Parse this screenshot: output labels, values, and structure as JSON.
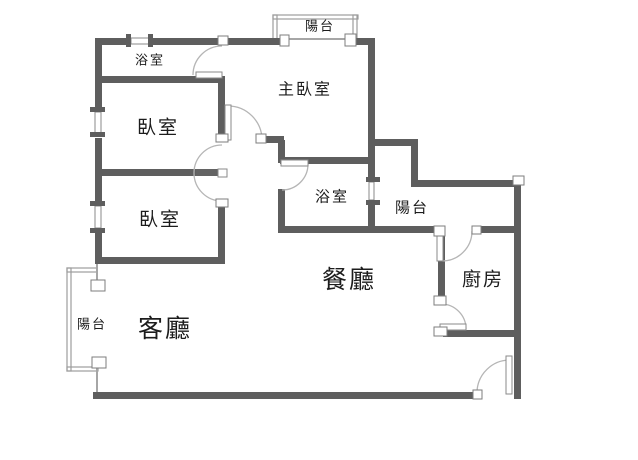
{
  "plan": {
    "title": "apartment-floor-plan",
    "canvas": {
      "w": 638,
      "h": 460
    },
    "colors": {
      "background": "#ffffff",
      "wall": "#5e5e5e",
      "thin_line": "#a6a6a6",
      "railing": "#9d9d9d",
      "arc": "#b5b5b5",
      "post_fill": "#ffffff",
      "post_border": "#7d7d7d",
      "window_fill": "#ffffff",
      "window_border": "#8a8a8a",
      "leaf_light_fill": "#ffffff",
      "leaf_light_border": "#8a8a8a",
      "leaf_dark": "#636363",
      "text": "#1c1c1c"
    },
    "rooms": [
      {
        "id": "balcony-top",
        "label": "陽台",
        "x": 320,
        "y": 27,
        "size": 13
      },
      {
        "id": "bathroom-master",
        "label": "浴室",
        "x": 150,
        "y": 61,
        "size": 13
      },
      {
        "id": "master-bedroom",
        "label": "主臥室",
        "x": 305,
        "y": 90,
        "size": 16
      },
      {
        "id": "bedroom-1",
        "label": "臥室",
        "x": 158,
        "y": 128,
        "size": 19
      },
      {
        "id": "bedroom-2",
        "label": "臥室",
        "x": 160,
        "y": 220,
        "size": 19
      },
      {
        "id": "bathroom-2",
        "label": "浴室",
        "x": 332,
        "y": 197,
        "size": 15
      },
      {
        "id": "balcony-right",
        "label": "陽台",
        "x": 412,
        "y": 208,
        "size": 15
      },
      {
        "id": "dining-room",
        "label": "餐廳",
        "x": 349,
        "y": 281,
        "size": 25
      },
      {
        "id": "kitchen",
        "label": "廚房",
        "x": 483,
        "y": 280,
        "size": 19
      },
      {
        "id": "living-room",
        "label": "客廳",
        "x": 165,
        "y": 330,
        "size": 25
      },
      {
        "id": "balcony-left",
        "label": "陽台",
        "x": 92,
        "y": 325,
        "size": 13
      }
    ],
    "walls": [
      {
        "x": 95,
        "y": 38,
        "w": 33,
        "h": 7
      },
      {
        "x": 153,
        "y": 38,
        "w": 67,
        "h": 7
      },
      {
        "x": 228,
        "y": 38,
        "w": 54,
        "h": 7
      },
      {
        "x": 354,
        "y": 38,
        "w": 21,
        "h": 7
      },
      {
        "x": 95,
        "y": 38,
        "w": 7,
        "h": 69
      },
      {
        "x": 95,
        "y": 138,
        "w": 7,
        "h": 63
      },
      {
        "x": 95,
        "y": 233,
        "w": 7,
        "h": 31
      },
      {
        "x": 98,
        "y": 76,
        "w": 126,
        "h": 7
      },
      {
        "x": 218,
        "y": 76,
        "w": 7,
        "h": 60
      },
      {
        "x": 218,
        "y": 206,
        "w": 7,
        "h": 58
      },
      {
        "x": 98,
        "y": 169,
        "w": 100,
        "h": 7
      },
      {
        "x": 95,
        "y": 257,
        "w": 130,
        "h": 7
      },
      {
        "x": 368,
        "y": 38,
        "w": 7,
        "h": 140
      },
      {
        "x": 368,
        "y": 204,
        "w": 7,
        "h": 29
      },
      {
        "x": 261,
        "y": 136,
        "w": 23,
        "h": 7
      },
      {
        "x": 278,
        "y": 140,
        "w": 7,
        "h": 23
      },
      {
        "x": 280,
        "y": 157,
        "w": 95,
        "h": 7
      },
      {
        "x": 278,
        "y": 189,
        "w": 7,
        "h": 44
      },
      {
        "x": 278,
        "y": 226,
        "w": 160,
        "h": 7
      },
      {
        "x": 479,
        "y": 226,
        "w": 40,
        "h": 7
      },
      {
        "x": 370,
        "y": 139,
        "w": 48,
        "h": 7
      },
      {
        "x": 411,
        "y": 141,
        "w": 7,
        "h": 46
      },
      {
        "x": 411,
        "y": 180,
        "w": 110,
        "h": 7
      },
      {
        "x": 514,
        "y": 183,
        "w": 7,
        "h": 216
      },
      {
        "x": 438,
        "y": 233,
        "w": 7,
        "h": 65
      },
      {
        "x": 443,
        "y": 330,
        "w": 76,
        "h": 7
      },
      {
        "x": 93,
        "y": 392,
        "w": 384,
        "h": 7
      }
    ],
    "thin_lines": [
      {
        "x": 289,
        "y": 38,
        "w": 57,
        "h": 2
      },
      {
        "x": 96,
        "y": 263,
        "w": 2,
        "h": 18
      },
      {
        "x": 96,
        "y": 367,
        "w": 2,
        "h": 26
      }
    ],
    "railings": [
      {
        "x": 273,
        "y": 15,
        "w": 85,
        "h": 4
      },
      {
        "x": 273,
        "y": 15,
        "w": 4,
        "h": 24
      },
      {
        "x": 353,
        "y": 15,
        "w": 4,
        "h": 24
      },
      {
        "x": 67,
        "y": 268,
        "w": 4,
        "h": 103
      },
      {
        "x": 67,
        "y": 268,
        "w": 30,
        "h": 4
      },
      {
        "x": 67,
        "y": 367,
        "w": 31,
        "h": 4
      }
    ],
    "window_panes": [
      {
        "x": 131,
        "y": 38,
        "w": 18,
        "h": 6
      },
      {
        "x": 95,
        "y": 112,
        "w": 6,
        "h": 21
      },
      {
        "x": 95,
        "y": 206,
        "w": 6,
        "h": 22
      },
      {
        "x": 369,
        "y": 182,
        "w": 5,
        "h": 18
      }
    ],
    "window_ticks": [
      {
        "x": 126,
        "y": 34,
        "w": 5,
        "h": 13
      },
      {
        "x": 148,
        "y": 34,
        "w": 5,
        "h": 13
      },
      {
        "x": 90,
        "y": 107,
        "w": 15,
        "h": 5
      },
      {
        "x": 90,
        "y": 132,
        "w": 15,
        "h": 5
      },
      {
        "x": 90,
        "y": 201,
        "w": 15,
        "h": 5
      },
      {
        "x": 90,
        "y": 228,
        "w": 15,
        "h": 5
      },
      {
        "x": 366,
        "y": 177,
        "w": 14,
        "h": 5
      },
      {
        "x": 366,
        "y": 200,
        "w": 14,
        "h": 5
      }
    ],
    "posts": [
      {
        "x": 280,
        "y": 35,
        "w": 9,
        "h": 11
      },
      {
        "x": 345,
        "y": 34,
        "w": 11,
        "h": 12
      },
      {
        "x": 218,
        "y": 36,
        "w": 10,
        "h": 9
      },
      {
        "x": 216,
        "y": 134,
        "w": 12,
        "h": 8
      },
      {
        "x": 256,
        "y": 134,
        "w": 10,
        "h": 9
      },
      {
        "x": 216,
        "y": 199,
        "w": 12,
        "h": 8
      },
      {
        "x": 91,
        "y": 280,
        "w": 14,
        "h": 11
      },
      {
        "x": 92,
        "y": 357,
        "w": 14,
        "h": 11
      },
      {
        "x": 434,
        "y": 226,
        "w": 11,
        "h": 10
      },
      {
        "x": 472,
        "y": 226,
        "w": 9,
        "h": 8
      },
      {
        "x": 434,
        "y": 296,
        "w": 12,
        "h": 9
      },
      {
        "x": 434,
        "y": 327,
        "w": 13,
        "h": 9
      },
      {
        "x": 473,
        "y": 390,
        "w": 9,
        "h": 9
      },
      {
        "x": 513,
        "y": 176,
        "w": 11,
        "h": 9
      }
    ],
    "door_leaves": [
      {
        "id": "bathroom-master-door-leaf",
        "x": 196,
        "y": 72,
        "w": 26,
        "h": 6,
        "style": "light"
      },
      {
        "id": "master-bedroom-door-leaf",
        "x": 225,
        "y": 105,
        "w": 6,
        "h": 35,
        "style": "light"
      },
      {
        "id": "bedroom-doors-leaf",
        "x": 196,
        "y": 169,
        "w": 27,
        "h": 7,
        "style": "dark"
      },
      {
        "id": "bedroom-doors-leaf-cap",
        "x": 218,
        "y": 169,
        "w": 9,
        "h": 8,
        "style": "light"
      },
      {
        "id": "bathroom-2-door-leaf",
        "x": 281,
        "y": 160,
        "w": 27,
        "h": 6,
        "style": "light"
      },
      {
        "id": "kitchen-north-door-leaf",
        "x": 437,
        "y": 234,
        "w": 6,
        "h": 27,
        "style": "light"
      },
      {
        "id": "kitchen-west-door-leaf",
        "x": 440,
        "y": 324,
        "w": 26,
        "h": 6,
        "style": "light"
      },
      {
        "id": "entry-door-leaf",
        "x": 506,
        "y": 356,
        "w": 6,
        "h": 38,
        "style": "light"
      }
    ],
    "door_arcs": [
      {
        "id": "bathroom-master-door-arc",
        "d": "M222,46 A29,29 0 0 0 193,75"
      },
      {
        "id": "master-bedroom-door-arc",
        "d": "M228,106 A34,34 0 0 1 262,140"
      },
      {
        "id": "bedroom-doors-arc",
        "d": "M222,145 A28,28 0 0 0 194,173 A28,28 0 0 0 222,201"
      },
      {
        "id": "bathroom-2-door-arc",
        "d": "M308,164 A26,26 0 0 1 282,190"
      },
      {
        "id": "kitchen-north-door-arc",
        "d": "M442,261 A30,30 0 0 0 472,231"
      },
      {
        "id": "kitchen-west-door-arc",
        "d": "M441,304 A25,25 0 0 1 466,329"
      },
      {
        "id": "entry-door-arc",
        "d": "M477,392 A33,33 0 0 1 510,360"
      }
    ]
  }
}
